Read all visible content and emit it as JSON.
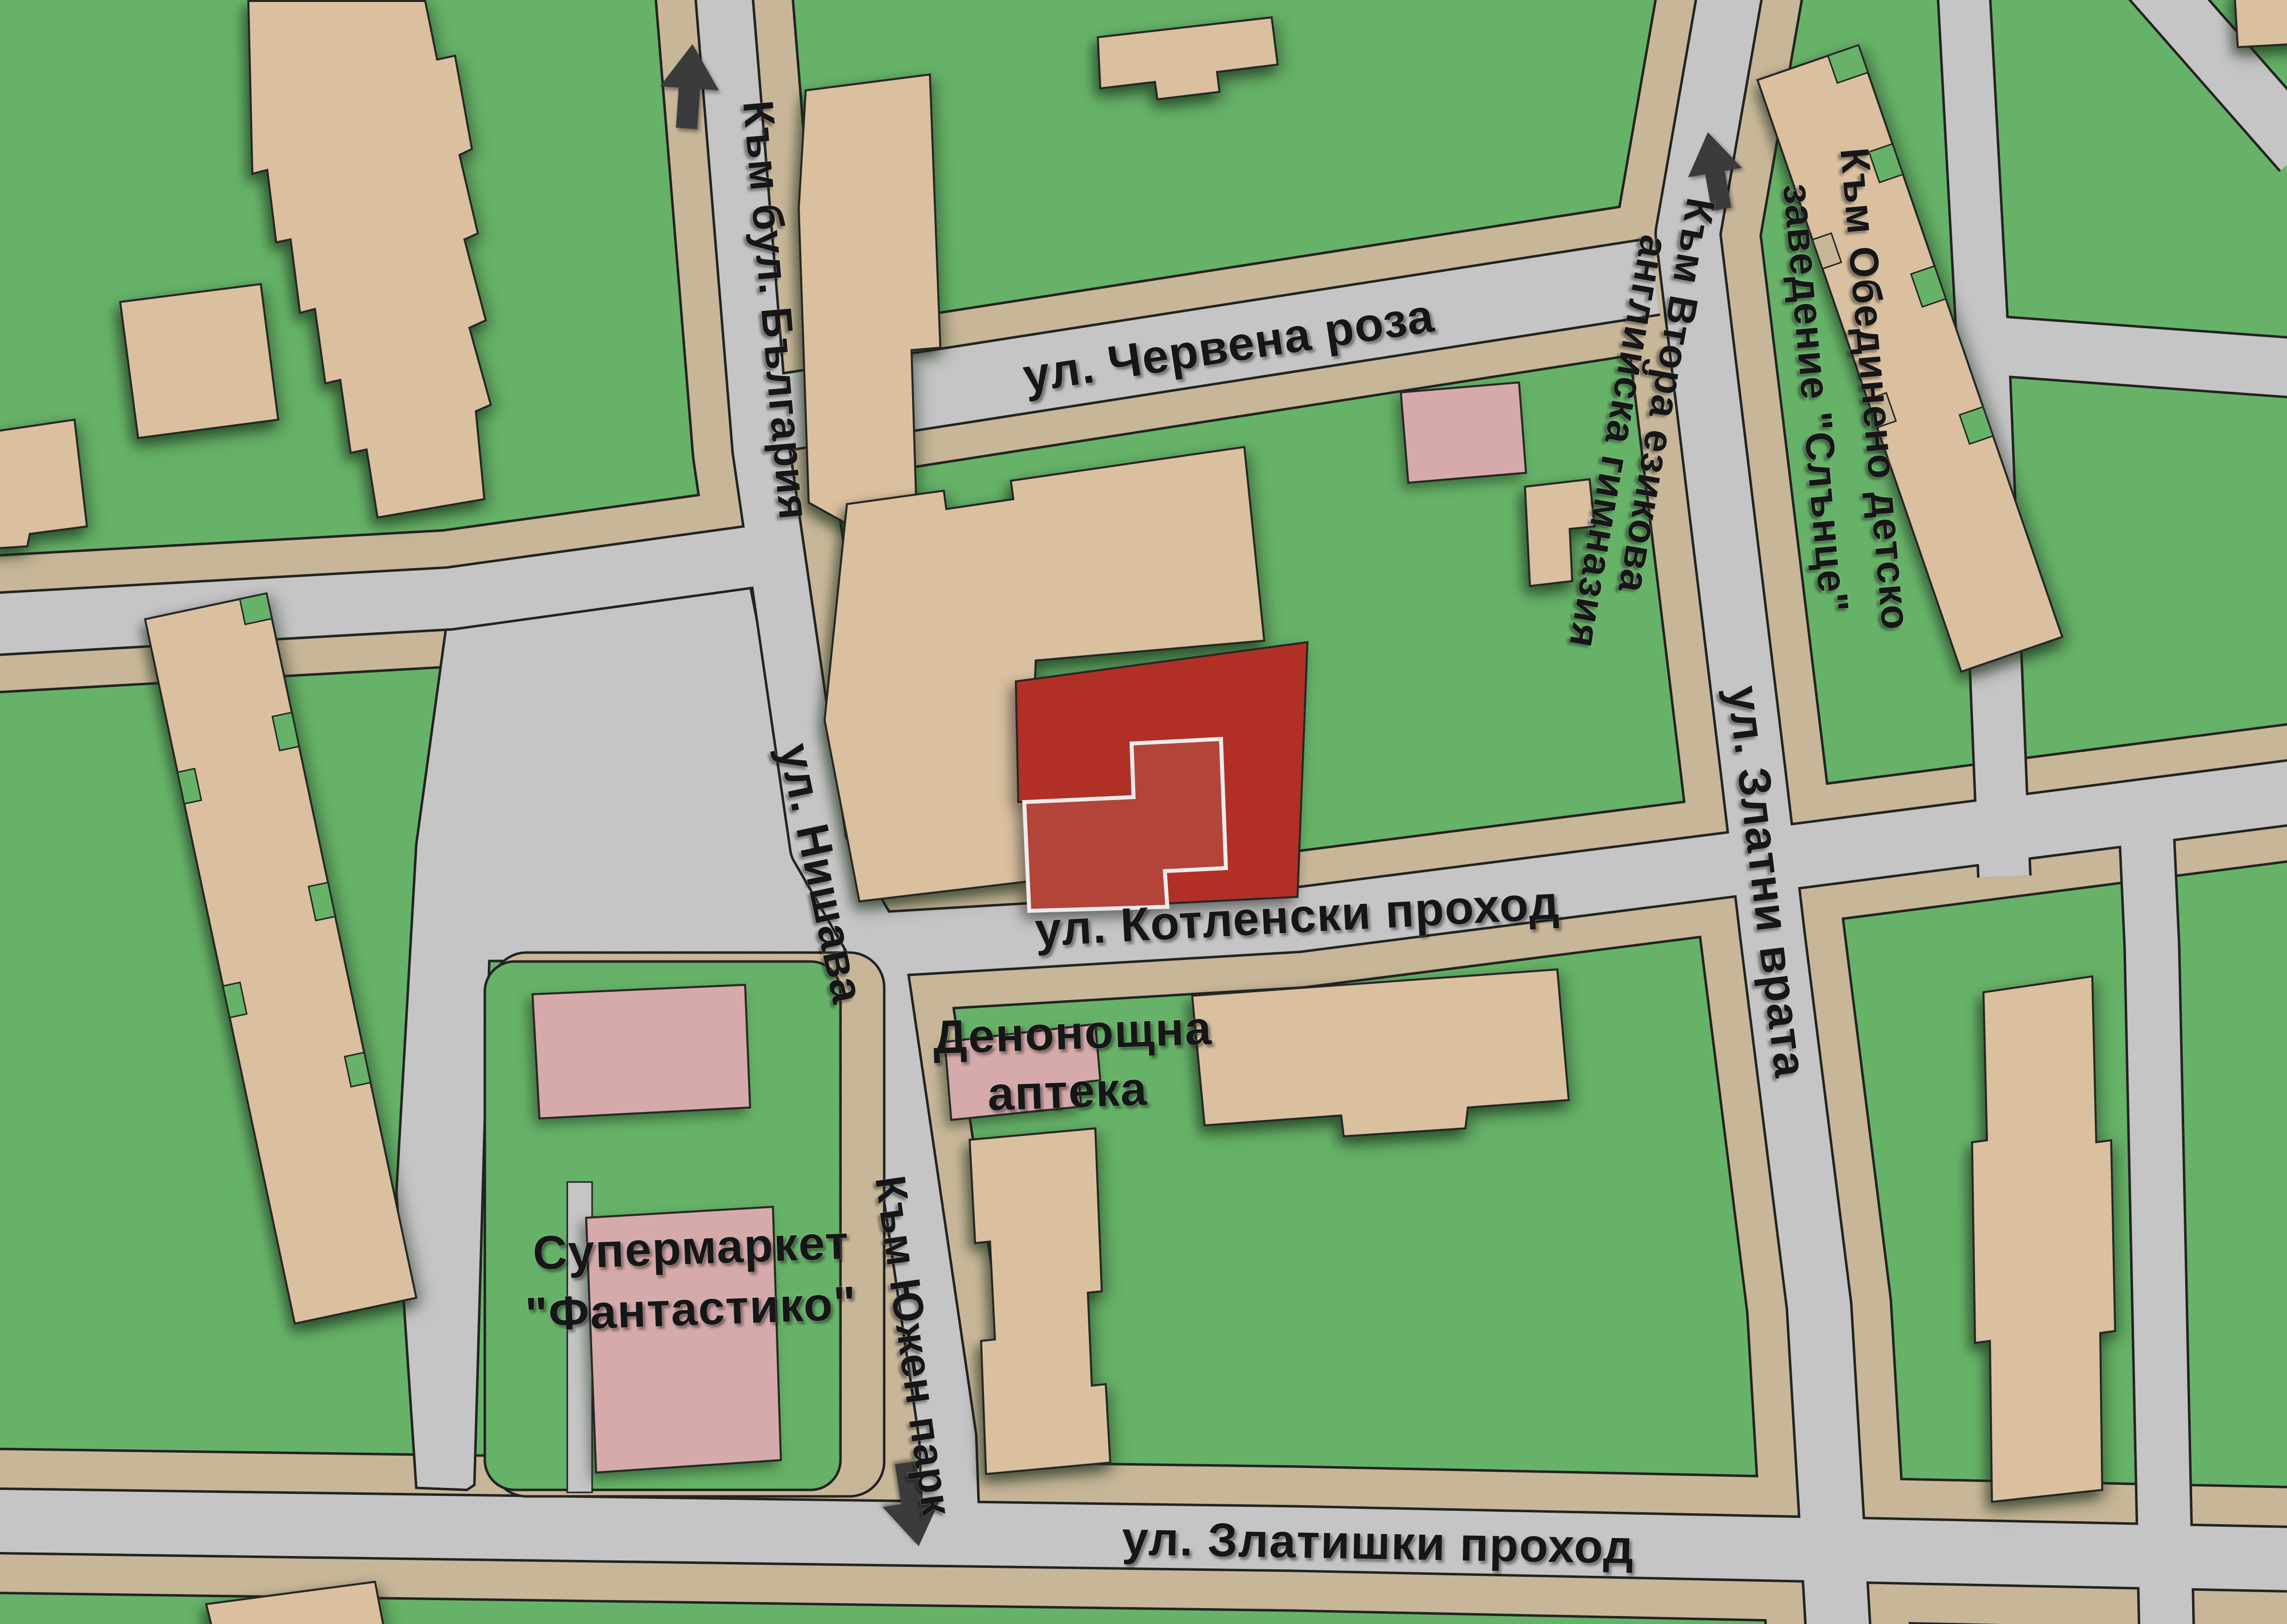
{
  "map": {
    "colors": {
      "grass": "#5cb15e",
      "road": "#c6c6c6",
      "sidewalk": "#c9b694",
      "outline": "#101010",
      "building_residential": "#dec19c",
      "building_commercial": "#d9a7a8",
      "highlight_outer": "#b01f14",
      "highlight_inner": "#b2362b",
      "highlight_border": "#f2f2f2",
      "arrow": "#3b3b3b",
      "text": "#161616"
    },
    "street_labels": {
      "chervena_roza": "ул. Червена роза",
      "zlatni_vrata": "ул. Златни врата",
      "nishava": "ул. Нишава",
      "kotlenski_prohod": "ул. Котленски проход",
      "zlatishki_prohod": "ул. Златишки проход"
    },
    "direction_labels": {
      "bulgaria": "Към бул. България",
      "vtora_line1": "Към Втора езикова",
      "vtora_line2": "английска гимназия",
      "obedineno_line1": "Към Обединено детско",
      "obedineno_line2": "заведение \"Слънце\"",
      "yuzhen_park": "Към Южен парк"
    },
    "poi_labels": {
      "pharmacy_line1": "Денонощна",
      "pharmacy_line2": "аптека",
      "supermarket_line1": "Супермаркет",
      "supermarket_line2": "\"Фантастико\""
    },
    "arrows": {
      "north_bulgaria": "up",
      "north_gymnasium": "up",
      "south_yuzhen_park": "down"
    }
  }
}
